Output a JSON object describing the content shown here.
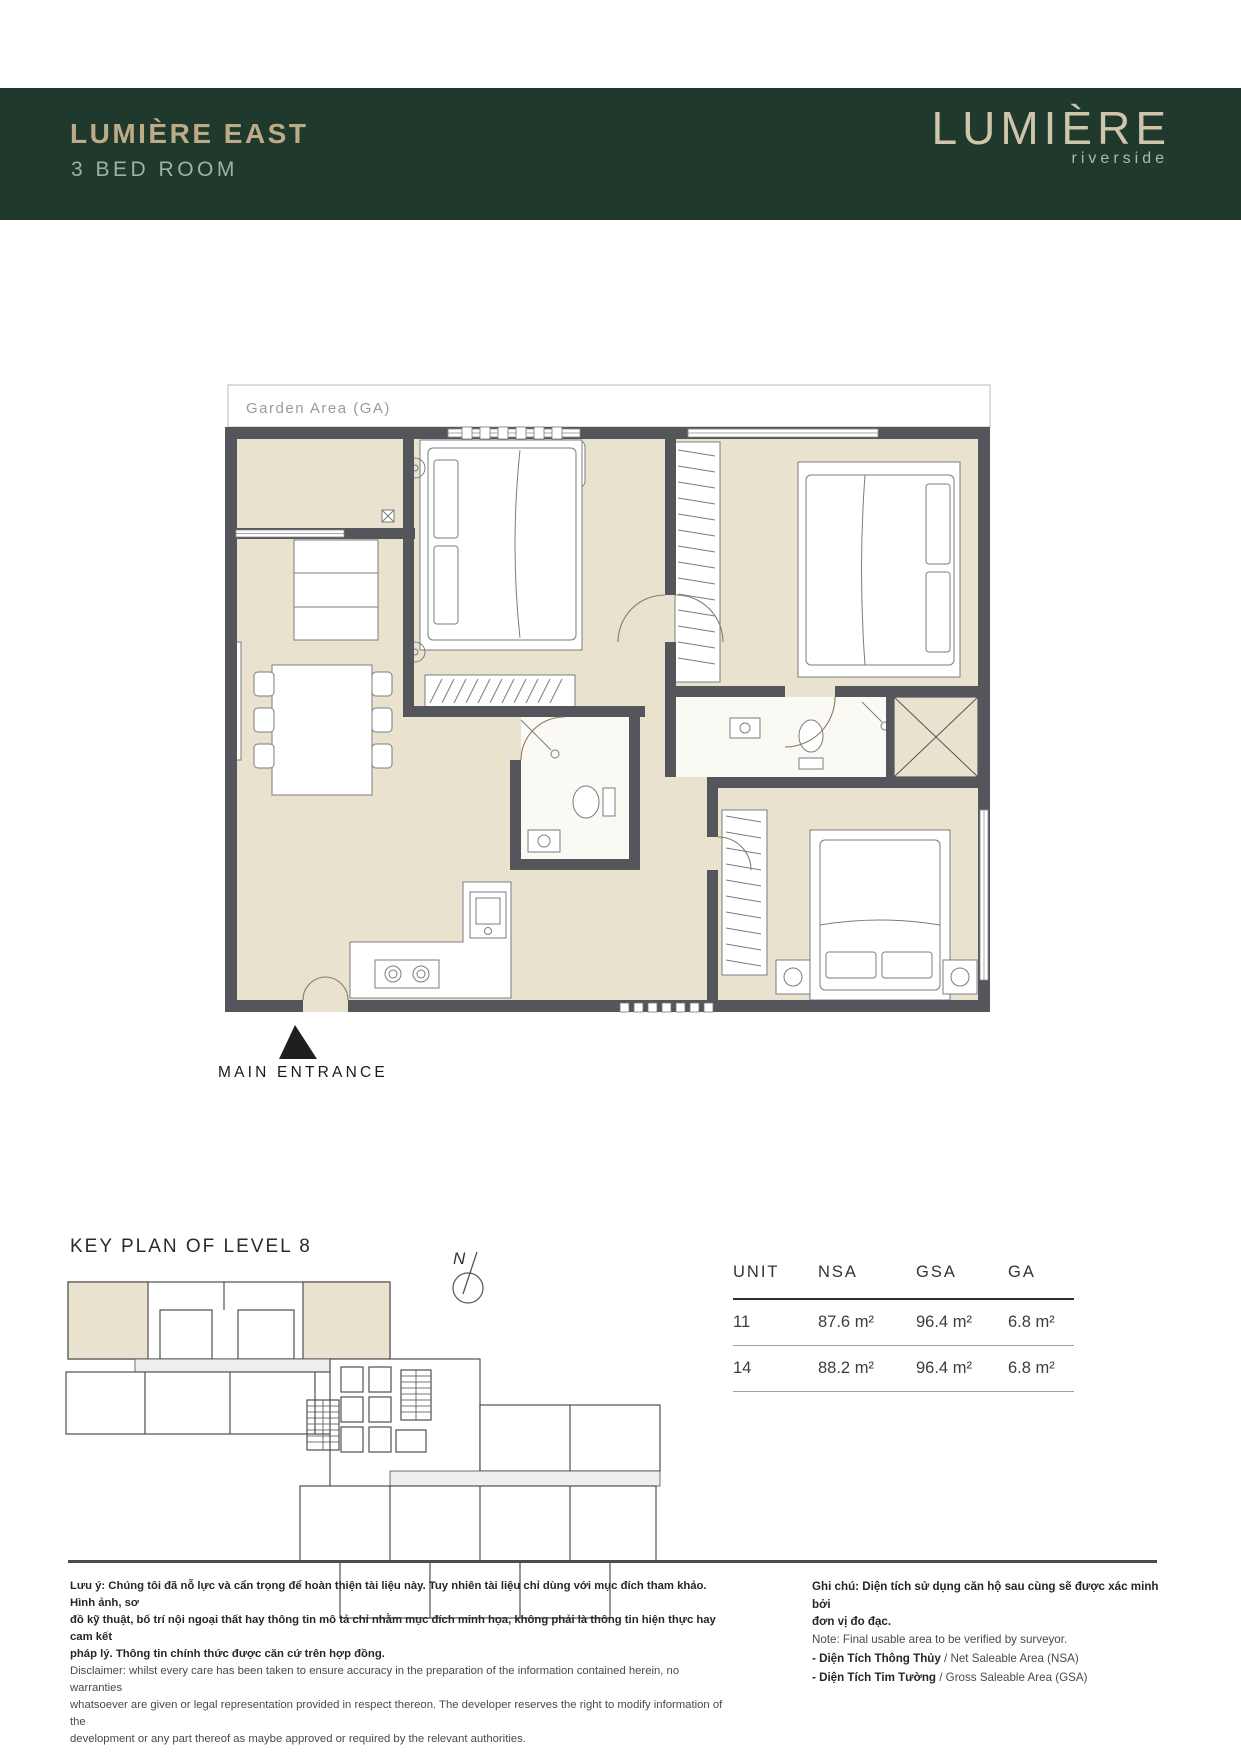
{
  "header": {
    "title": "LUMIÈRE EAST",
    "subtitle": "3 BED ROOM",
    "logo_name": "LUMIÈRE",
    "logo_tagline": "riverside",
    "bg_color": "#20392d",
    "title_color": "#bcab87"
  },
  "floor_plan": {
    "garden_area_label": "Garden Area (GA)",
    "main_entrance_label": "MAIN ENTRANCE",
    "floor_color": "#e9e2cf",
    "wall_color": "#55565b"
  },
  "key_plan": {
    "title": "KEY PLAN OF LEVEL 8",
    "compass_label": "N",
    "highlight_color": "#e9e2cf"
  },
  "area_table": {
    "columns": [
      "UNIT",
      "NSA",
      "GSA",
      "GA"
    ],
    "rows": [
      [
        "11",
        "87.6 m²",
        "96.4 m²",
        "6.8 m²"
      ],
      [
        "14",
        "88.2 m²",
        "96.4 m²",
        "6.8 m²"
      ]
    ]
  },
  "footer": {
    "note_vi": "Lưu ý: Chúng tôi đã nỗ lực và cẩn trọng để hoàn thiện tài liệu này. Tuy nhiên tài liệu chỉ dùng với mục đích tham khảo. Hình ảnh, sơ\nđồ kỹ thuật, bố trí nội ngoại thất hay thông tin mô tả chỉ nhằm mục đích minh họa, không phải là thông tin hiện thực hay cam kết\npháp lý. Thông tin chính thức được căn cứ trên hợp đồng.",
    "note_en": "Disclaimer: whilst every care has been taken to ensure accuracy in the preparation of the information contained herein, no warranties\nwhatsoever are given or legal representation provided in respect thereon. The developer reserves the right to modify information of the\ndevelopment or any part thereof as maybe approved or required by the relevant authorities.",
    "legend_vi": "Ghi chú: Diện tích sử dụng căn hộ sau cùng sẽ được xác minh bởi\nđơn vị đo đạc.",
    "legend_note": "Note: Final usable area to be verified by surveyor.",
    "legend_items": [
      {
        "vi": "- Diện Tích Thông Thủy",
        "en": "/ Net Saleable Area (NSA)"
      },
      {
        "vi": "- Diện Tích Tim Tường",
        "en": "/ Gross Saleable Area (GSA)"
      }
    ]
  }
}
